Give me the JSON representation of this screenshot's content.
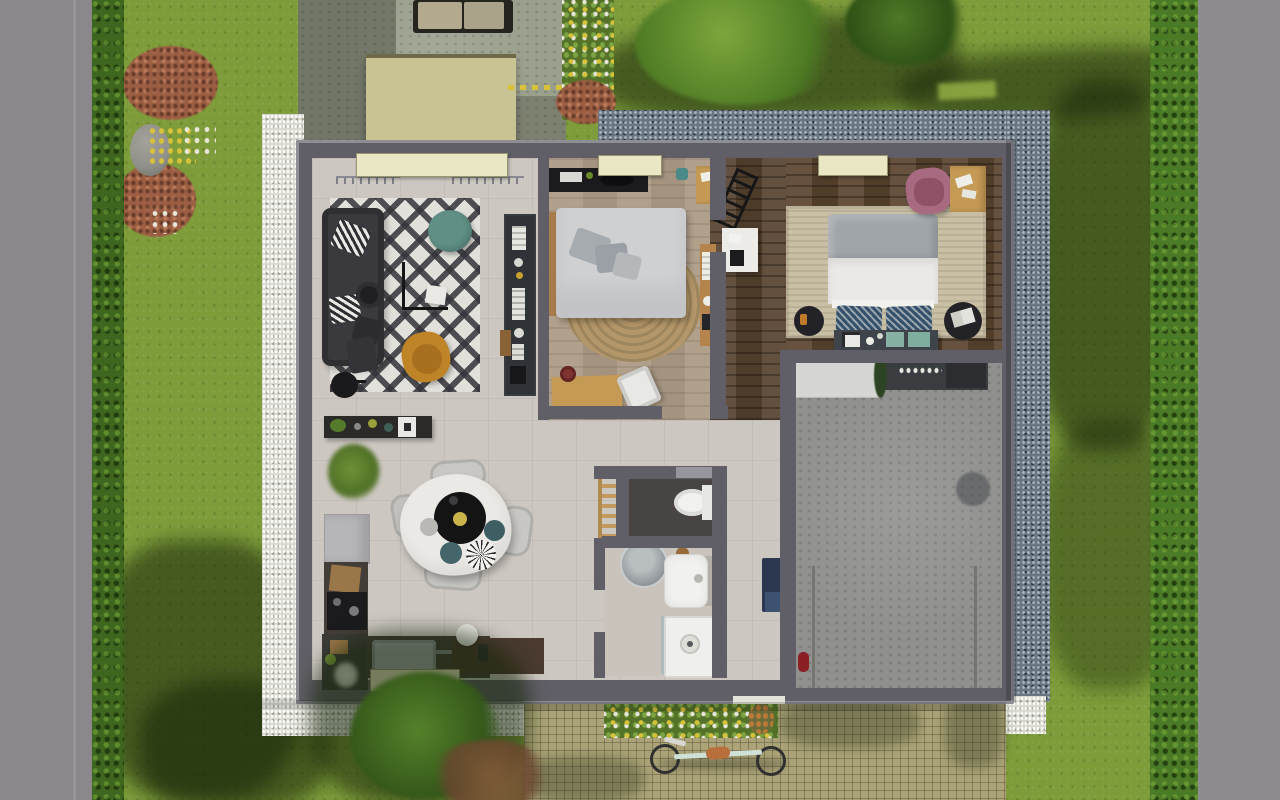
{
  "scene": {
    "kind": "3d-top-down-floor-plan-render",
    "rooms": [
      "living-room",
      "bedroom-1",
      "bedroom-2",
      "entry-hall",
      "bathroom",
      "wc",
      "kitchen-dining",
      "garage"
    ],
    "outdoor": [
      "road",
      "hedge",
      "lawn",
      "flower-beds",
      "driveway",
      "carport",
      "outdoor-sofa",
      "gravel-border-white",
      "gravel-border-blue",
      "paver-path",
      "bicycle",
      "trees"
    ]
  },
  "palette": {
    "lawn": "#7E9C3A",
    "lawn_bright": "#95B044",
    "hedge": "#3E661F",
    "road": "#8A888C",
    "road_right": "#8E8C91",
    "concrete": "#9BA08D",
    "carport": "#C9C394",
    "gravel_blue": "#6A7682",
    "gravel_white": "#D8D8CE",
    "paver": "#ACA478",
    "wall": "#605F67",
    "wall_light": "#8F8E95",
    "sill": "#EAE7C4",
    "tile": "#CDC7C1",
    "wood_light": "#AC9B86",
    "wood_dark": "#57432F",
    "garage_floor": "#90908E",
    "wc_floor": "#474441",
    "bath_floor": "#C9C3BC",
    "rug_base": "#E2E0DA",
    "sofa": "#3A3A3E",
    "coffee_teal": "#5F8F85",
    "mustard": "#BF8428",
    "mustard_dark": "#A76F1E",
    "jute": "#B3976A",
    "bed_linen": "#CFD0D2",
    "pillow_gray": "#A6ABAF",
    "headboard_wood": "#A67C4A",
    "tv_unit": "#2F3237",
    "sideboard": "#2B2A28",
    "plant": "#567A2B",
    "dresser": "#1B1B1D",
    "desk_wood": "#C59A55",
    "wardrobe": "#B5834C",
    "chair_white": "#E8E8E4",
    "duvet": "#EAE9E6",
    "headboard2": "#9FA5A9",
    "navy_pillow": "#35506B",
    "bench": "#3F434A",
    "teal_throw": "#86B1A3",
    "side_table": "#232327",
    "pink_chair": "#A86A80",
    "pink_inner": "#8F5266",
    "rug2": "#C9BFA4",
    "workbench": "#D6D6D4",
    "shelf_dark": "#3A3D40",
    "extinguisher": "#8A1F24",
    "ladder_wood": "#C29A5E",
    "porcelain": "#F1F1EF",
    "basin_gray": "#A9AEB0",
    "navy_cabinet": "#2B3850",
    "fridge": "#B6B6B8",
    "counter_dark": "#433D38",
    "cooktop": "#1B1B1E",
    "steel": "#A9ADB0",
    "runner": "#4A3A30",
    "table_white": "#EBE9E5",
    "tray_black": "#141414",
    "mustard_disc": "#C8B44A",
    "teal_plate": "#3D5F63",
    "chair_gray": "#C8C7C3",
    "flower_green": "#547329",
    "flower_yellow": "#D8C23A",
    "flower_white": "#E9E7DC",
    "shrub_red": "#9C5F43",
    "rock": "#90908A",
    "bike_frame": "#CFE0D6",
    "saddle": "#B96F3C",
    "wheel": "#303030"
  }
}
